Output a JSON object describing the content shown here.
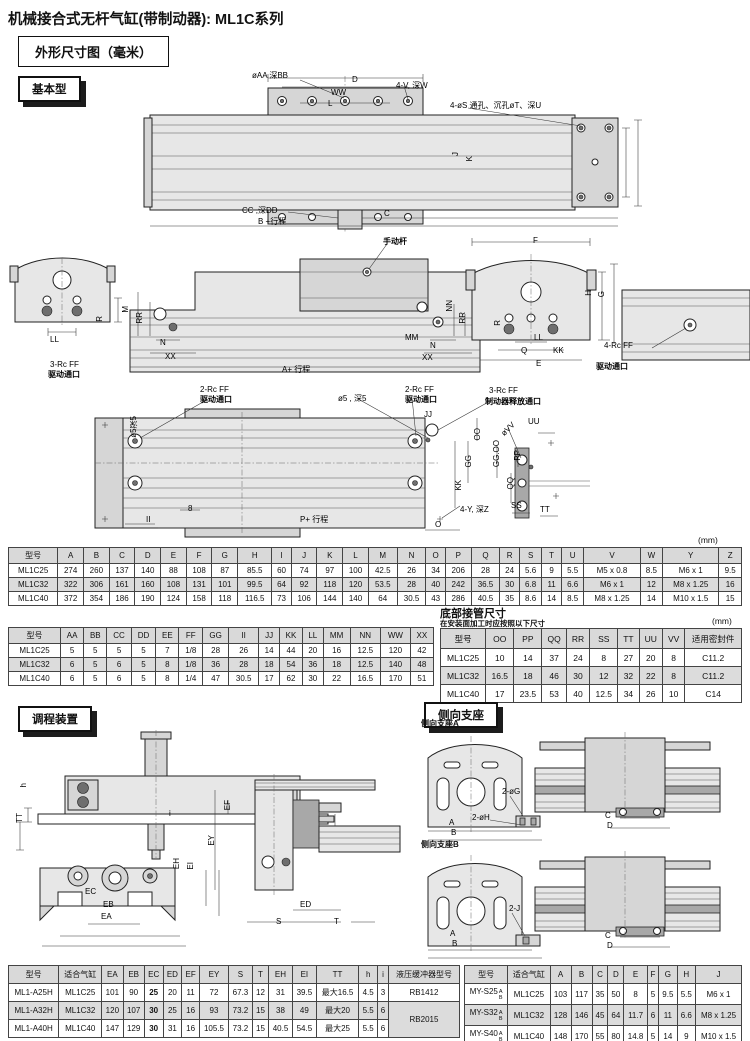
{
  "page": {
    "title": "机械接合式无杆气缸(带制动器): ML1C系列",
    "dim_box": "外形尺寸图（毫米）",
    "unit_mm": "(mm)"
  },
  "tabs": {
    "basic": "基本型",
    "adjuster": "调程装置",
    "side_support": "侧向支座"
  },
  "d1": {
    "aa_bb": "øAA 深BB",
    "d": "D",
    "ww": "WW",
    "l": "L",
    "v_w": "4-V, 深W",
    "s_t_u": "4-øS 通孔、沉孔øT、深U",
    "j": "J",
    "k": "K",
    "cc_dd": "CC ,深DD",
    "b_stroke": "B +行程",
    "c": "C"
  },
  "d2": {
    "manual_lever": "手动杆",
    "f": "F",
    "m": "M",
    "rr_left": "RR",
    "r_left": "R",
    "ll_left": "LL",
    "n_left": "N",
    "xx_left": "XX",
    "port3": "3-Rc FF",
    "port3_name": "驱动通口",
    "a_stroke": "A+ 行程",
    "mm": "MM",
    "nn": "NN",
    "rr_mid": "RR",
    "n_mid": "N",
    "xx_mid": "XX",
    "r_mid": "R",
    "ll_mid": "LL",
    "q": "Q",
    "kk": "KK",
    "e": "E",
    "h": "H",
    "g": "G",
    "port4": "4-Rc FF",
    "port4_name": "驱动通口"
  },
  "d3": {
    "port2a": "2-Rc FF",
    "port2a_name": "驱动通口",
    "hole5": "ø5 , 深5",
    "port2b": "2-Rc FF",
    "port2b_name": "驱动通口",
    "jj": "JJ",
    "port3b": "3-Rc FF",
    "port3b_name": "制动器释放通口",
    "oo": "OO",
    "gg": "GG",
    "kk": "KK",
    "hole5_left": "ø5深5",
    "eight": "8",
    "ii": "II",
    "p_stroke": "P+ 行程",
    "o": "O",
    "y_z": "4-Y, 深Z",
    "vv": "øVV",
    "uu": "UU",
    "gg_oo": "GG.OO",
    "pp": "PP",
    "qq": "QQ",
    "ss": "SS",
    "tt": "TT"
  },
  "ad": {
    "h": "h",
    "tt": "TT",
    "i": "i",
    "ec": "EC",
    "eb": "EB",
    "ea": "EA",
    "eh": "EH",
    "ei": "EI",
    "ef": "EF",
    "ey": "EY",
    "ed": "ED",
    "s": "S",
    "t": "T"
  },
  "ss": {
    "label_a": "侧向支座A",
    "label_b": "侧向支座B",
    "g": "2-øG",
    "h": "2-øH",
    "a1": "A",
    "b1": "B",
    "c1": "C",
    "d1": "D",
    "j": "2-J",
    "a2": "A",
    "b2": "B",
    "c2": "C",
    "d2": "D"
  },
  "bottom_piping": {
    "title": "底部接管尺寸",
    "subtitle": "在安装面加工时应按照以下尺寸",
    "unit": "(mm)"
  },
  "tables": {
    "main": {
      "headers": [
        "型号",
        "A",
        "B",
        "C",
        "D",
        "E",
        "F",
        "G",
        "H",
        "I",
        "J",
        "K",
        "L",
        "M",
        "N",
        "O",
        "P",
        "Q",
        "R",
        "S",
        "T",
        "U",
        "V",
        "W",
        "Y",
        "Z"
      ],
      "rows": [
        [
          "ML1C25",
          "274",
          "260",
          "137",
          "140",
          "88",
          "108",
          "87",
          "85.5",
          "60",
          "74",
          "97",
          "100",
          "42.5",
          "26",
          "34",
          "206",
          "28",
          "24",
          "5.6",
          "9",
          "5.5",
          "M5 x 0.8",
          "8.5",
          "M6 x 1",
          "9.5"
        ],
        [
          "ML1C32",
          "322",
          "306",
          "161",
          "160",
          "108",
          "131",
          "101",
          "99.5",
          "64",
          "92",
          "118",
          "120",
          "53.5",
          "28",
          "40",
          "242",
          "36.5",
          "30",
          "6.8",
          "11",
          "6.6",
          "M6 x 1",
          "12",
          "M8 x 1.25",
          "16"
        ],
        [
          "ML1C40",
          "372",
          "354",
          "186",
          "190",
          "124",
          "158",
          "118",
          "116.5",
          "73",
          "106",
          "144",
          "140",
          "64",
          "30.5",
          "43",
          "286",
          "40.5",
          "35",
          "8.6",
          "14",
          "8.5",
          "M8 x 1.25",
          "14",
          "M10 x 1.5",
          "15"
        ]
      ]
    },
    "aux": {
      "headers": [
        "型号",
        "AA",
        "BB",
        "CC",
        "DD",
        "EE",
        "FF",
        "GG",
        "II",
        "JJ",
        "KK",
        "LL",
        "MM",
        "NN",
        "WW",
        "XX"
      ],
      "rows": [
        [
          "ML1C25",
          "5",
          "5",
          "5",
          "5",
          "7",
          "1/8",
          "28",
          "26",
          "14",
          "44",
          "20",
          "16",
          "12.5",
          "120",
          "42"
        ],
        [
          "ML1C32",
          "6",
          "5",
          "6",
          "5",
          "8",
          "1/8",
          "36",
          "28",
          "18",
          "54",
          "36",
          "18",
          "12.5",
          "140",
          "48"
        ],
        [
          "ML1C40",
          "6",
          "5",
          "6",
          "5",
          "8",
          "1/4",
          "47",
          "30.5",
          "17",
          "62",
          "30",
          "22",
          "16.5",
          "170",
          "51"
        ]
      ]
    },
    "piping": {
      "headers": [
        "型号",
        "OO",
        "PP",
        "QQ",
        "RR",
        "SS",
        "TT",
        "UU",
        "VV",
        "适用密封件"
      ],
      "rows": [
        [
          "ML1C25",
          "10",
          "14",
          "37",
          "24",
          "8",
          "27",
          "20",
          "8",
          "C11.2"
        ],
        [
          "ML1C32",
          "16.5",
          "18",
          "46",
          "30",
          "12",
          "32",
          "22",
          "8",
          "C11.2"
        ],
        [
          "ML1C40",
          "17",
          "23.5",
          "53",
          "40",
          "12.5",
          "34",
          "26",
          "10",
          "C14"
        ]
      ]
    },
    "adjuster": {
      "headers": [
        "型号",
        "适合气缸",
        "EA",
        "EB",
        "EC",
        "ED",
        "EF",
        "EY",
        "S",
        "T",
        "EH",
        "EI",
        "TT",
        "h",
        "i",
        "液压缓冲器型号"
      ],
      "rows": [
        [
          "ML1-A25H",
          "ML1C25",
          "101",
          "90",
          "25",
          "20",
          "11",
          "72",
          "67.3",
          "12",
          "31",
          "39.5",
          "最大16.5",
          "4.5",
          "3",
          "RB1412"
        ],
        [
          "ML1-A32H",
          "ML1C32",
          "120",
          "107",
          "30",
          "25",
          "16",
          "93",
          "73.2",
          "15",
          "38",
          "49",
          "最大20",
          "5.5",
          "6",
          "RB2015"
        ],
        [
          "ML1-A40H",
          "ML1C40",
          "147",
          "129",
          "30",
          "31",
          "16",
          "105.5",
          "73.2",
          "15",
          "40.5",
          "54.5",
          "最大25",
          "5.5",
          "6",
          null
        ]
      ]
    },
    "support": {
      "headers": [
        "型号",
        "适合气缸",
        "A",
        "B",
        "C",
        "D",
        "E",
        "F",
        "G",
        "H",
        "J"
      ],
      "rows": [
        [
          [
            "MY-S25",
            "A",
            "B"
          ],
          "ML1C25",
          "103",
          "117",
          "35",
          "50",
          "8",
          "5",
          "9.5",
          "5.5",
          "M6 x 1"
        ],
        [
          [
            "MY-S32",
            "A",
            "B"
          ],
          "ML1C32",
          "128",
          "146",
          "45",
          "64",
          "11.7",
          "6",
          "11",
          "6.6",
          "M8 x 1.25"
        ],
        [
          [
            "MY-S40",
            "A",
            "B"
          ],
          "ML1C40",
          "148",
          "170",
          "55",
          "80",
          "14.8",
          "5",
          "14",
          "9",
          "M10 x 1.5"
        ]
      ]
    }
  }
}
